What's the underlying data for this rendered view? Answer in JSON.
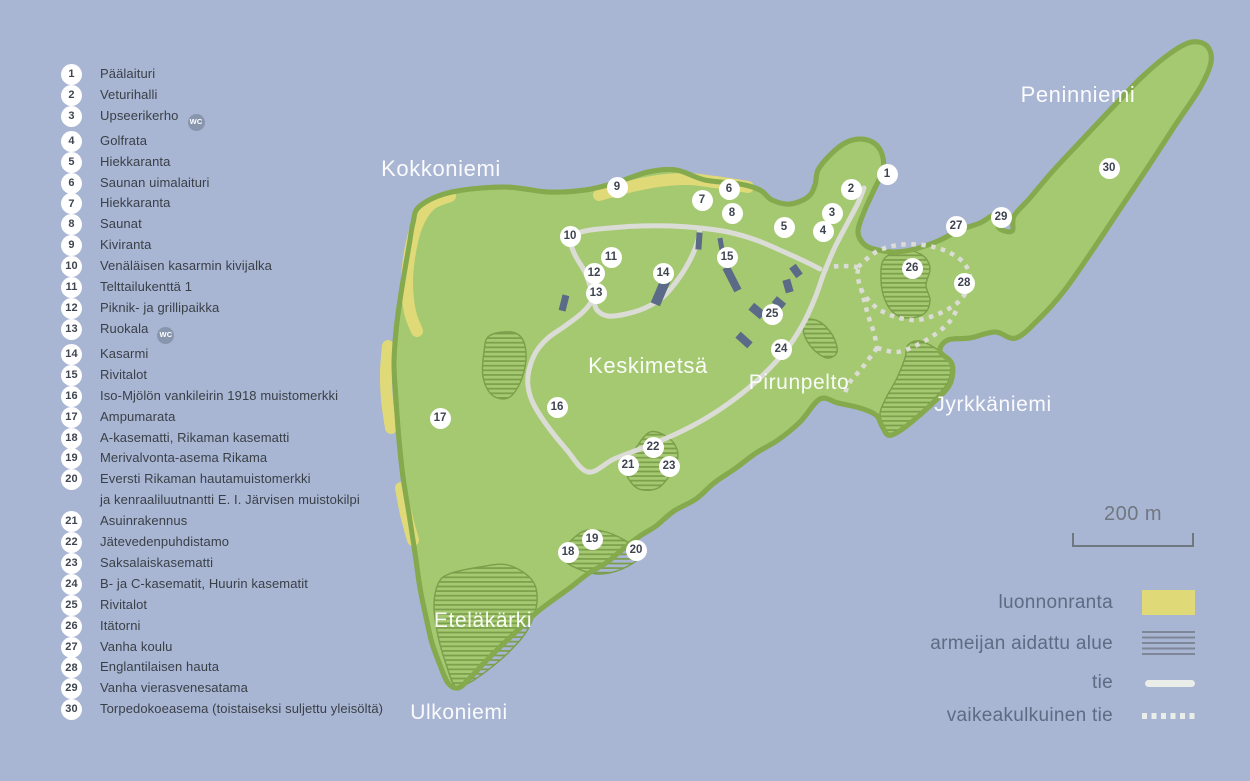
{
  "map": {
    "region_labels": [
      {
        "text": "Kokkoniemi",
        "x": 441,
        "y": 169,
        "size": 22
      },
      {
        "text": "Peninniemi",
        "x": 1078,
        "y": 95,
        "size": 22
      },
      {
        "text": "Keskimetsä",
        "x": 648,
        "y": 366,
        "size": 22
      },
      {
        "text": "Pirunpelto",
        "x": 799,
        "y": 383,
        "size": 21
      },
      {
        "text": "Jyrkkäniemi",
        "x": 993,
        "y": 405,
        "size": 21
      },
      {
        "text": "Eteläkärki",
        "x": 483,
        "y": 621,
        "size": 21
      },
      {
        "text": "Ulkoniemi",
        "x": 459,
        "y": 713,
        "size": 21
      }
    ],
    "markers": [
      {
        "num": "1",
        "x": 887,
        "y": 174
      },
      {
        "num": "2",
        "x": 851,
        "y": 189
      },
      {
        "num": "3",
        "x": 832,
        "y": 213
      },
      {
        "num": "4",
        "x": 823,
        "y": 231
      },
      {
        "num": "5",
        "x": 784,
        "y": 227
      },
      {
        "num": "6",
        "x": 729,
        "y": 189
      },
      {
        "num": "7",
        "x": 702,
        "y": 200
      },
      {
        "num": "8",
        "x": 732,
        "y": 213
      },
      {
        "num": "9",
        "x": 617,
        "y": 187
      },
      {
        "num": "10",
        "x": 570,
        "y": 236
      },
      {
        "num": "11",
        "x": 611,
        "y": 257
      },
      {
        "num": "12",
        "x": 594,
        "y": 273
      },
      {
        "num": "13",
        "x": 596,
        "y": 293
      },
      {
        "num": "14",
        "x": 663,
        "y": 273
      },
      {
        "num": "15",
        "x": 727,
        "y": 257
      },
      {
        "num": "16",
        "x": 557,
        "y": 407
      },
      {
        "num": "17",
        "x": 440,
        "y": 418
      },
      {
        "num": "18",
        "x": 568,
        "y": 552
      },
      {
        "num": "19",
        "x": 592,
        "y": 539
      },
      {
        "num": "20",
        "x": 636,
        "y": 550
      },
      {
        "num": "21",
        "x": 628,
        "y": 465
      },
      {
        "num": "22",
        "x": 653,
        "y": 447
      },
      {
        "num": "23",
        "x": 669,
        "y": 466
      },
      {
        "num": "24",
        "x": 781,
        "y": 349
      },
      {
        "num": "25",
        "x": 772,
        "y": 314
      },
      {
        "num": "26",
        "x": 912,
        "y": 268
      },
      {
        "num": "27",
        "x": 956,
        "y": 226
      },
      {
        "num": "28",
        "x": 964,
        "y": 283
      },
      {
        "num": "29",
        "x": 1001,
        "y": 217
      },
      {
        "num": "30",
        "x": 1109,
        "y": 168
      }
    ]
  },
  "poi_list": {
    "items": [
      {
        "num": "1",
        "label": "Päälaituri"
      },
      {
        "num": "2",
        "label": "Veturihalli"
      },
      {
        "num": "3",
        "label": "Upseerikerho",
        "badge": "WC"
      },
      {
        "num": "4",
        "label": "Golfrata"
      },
      {
        "num": "5",
        "label": "Hiekkaranta"
      },
      {
        "num": "6",
        "label": "Saunan uimalaituri"
      },
      {
        "num": "7",
        "label": "Hiekkaranta"
      },
      {
        "num": "8",
        "label": "Saunat"
      },
      {
        "num": "9",
        "label": "Kiviranta"
      },
      {
        "num": "10",
        "label": "Venäläisen kasarmin kivijalka"
      },
      {
        "num": "11",
        "label": "Telttailukenttä 1"
      },
      {
        "num": "12",
        "label": "Piknik- ja grillipaikka"
      },
      {
        "num": "13",
        "label": "Ruokala",
        "badge": "WC"
      },
      {
        "num": "14",
        "label": "Kasarmi"
      },
      {
        "num": "15",
        "label": "Rivitalot"
      },
      {
        "num": "16",
        "label": "Iso-Mjölön vankileirin 1918 muistomerkki"
      },
      {
        "num": "17",
        "label": "Ampumarata"
      },
      {
        "num": "18",
        "label": "A-kasematti, Rikaman kasematti"
      },
      {
        "num": "19",
        "label": "Merivalvonta-asema Rikama"
      },
      {
        "num": "20",
        "label": "Eversti Rikaman hautamuistomerkki",
        "label2": "ja kenraaliluutnantti E. I. Järvisen muistokilpi"
      },
      {
        "num": "21",
        "label": "Asuinrakennus"
      },
      {
        "num": "22",
        "label": "Jätevedenpuhdistamo"
      },
      {
        "num": "23",
        "label": "Saksalaiskasematti"
      },
      {
        "num": "24",
        "label": "B- ja C-kasematit, Huurin kasematit"
      },
      {
        "num": "25",
        "label": "Rivitalot"
      },
      {
        "num": "26",
        "label": "Itätorni"
      },
      {
        "num": "27",
        "label": "Vanha koulu"
      },
      {
        "num": "28",
        "label": "Englantilaisen hauta"
      },
      {
        "num": "29",
        "label": "Vanha vierasvenesatama"
      },
      {
        "num": "30",
        "label": "Torpedokoeasema (toistaiseksi suljettu yleisöltä)"
      }
    ]
  },
  "scale": {
    "label": "200 m"
  },
  "map_legend": {
    "items": [
      {
        "label": "luonnonranta",
        "kind": "beach"
      },
      {
        "label": "armeijan aidattu alue",
        "kind": "fenced"
      },
      {
        "label": "tie",
        "kind": "road"
      },
      {
        "label": "vaikeakulkuinen tie",
        "kind": "trail"
      }
    ]
  },
  "colors": {
    "water": "#a8b5d3",
    "land": "#a4c971",
    "coast": "#85aa4e",
    "beach": "#e0d977",
    "fenced_hatch": "#7b9e4a",
    "road": "#dcdcd6",
    "building": "#5b6b87",
    "marker_text": "#3e4550",
    "list_text": "#3a4047",
    "legend_text": "#5d6b83",
    "scale": "#6f7780",
    "wc_badge": "#8795ad"
  }
}
